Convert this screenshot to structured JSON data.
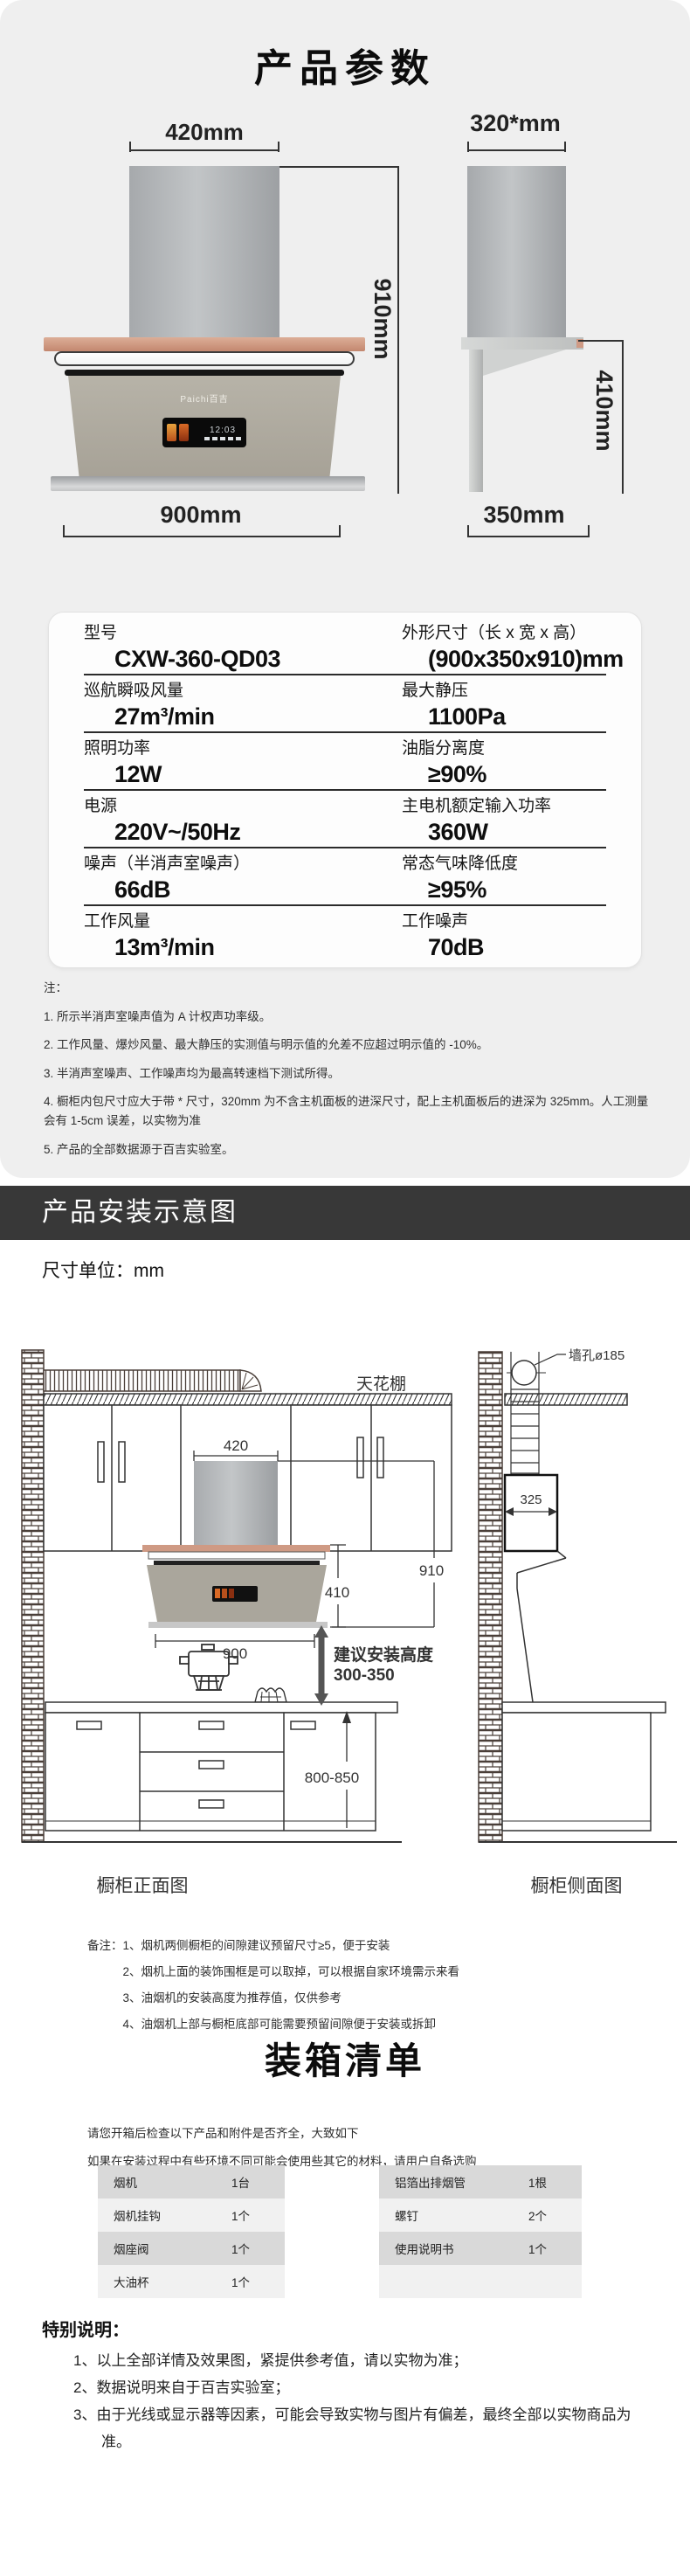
{
  "colors": {
    "panel_bg": "#efefef",
    "install_bar_bg": "#383838",
    "copper_accent": "#c3876f",
    "row_dark": "#d9d9d9",
    "row_light": "#f1f1f1"
  },
  "section_params": {
    "title": "产品参数",
    "front_view": {
      "top_width": "420mm",
      "height": "910mm",
      "bottom_width": "900mm",
      "brand": "Paichi百吉",
      "display_time": "12:03"
    },
    "side_view": {
      "top_width": "320*mm",
      "height": "410mm",
      "bottom_width": "350mm"
    },
    "spec_rows": [
      {
        "l_label": "型号",
        "l_value": "CXW-360-QD03",
        "r_label": "外形尺寸（长 x 宽 x 高）",
        "r_value": "(900x350x910)mm"
      },
      {
        "l_label": "巡航瞬吸风量",
        "l_value": "27m³/min",
        "r_label": "最大静压",
        "r_value": "1100Pa"
      },
      {
        "l_label": "照明功率",
        "l_value": "12W",
        "r_label": "油脂分离度",
        "r_value": "≥90%"
      },
      {
        "l_label": "电源",
        "l_value": "220V~/50Hz",
        "r_label": "主电机额定输入功率",
        "r_value": "360W"
      },
      {
        "l_label": "噪声（半消声室噪声）",
        "l_value": "66dB",
        "r_label": "常态气味降低度",
        "r_value": "≥95%"
      },
      {
        "l_label": "工作风量",
        "l_value": "13m³/min",
        "r_label": "工作噪声",
        "r_value": "70dB"
      }
    ],
    "notes_heading": "注：",
    "notes": [
      "1. 所示半消声室噪声值为 A 计权声功率级。",
      "2. 工作风量、爆炒风量、最大静压的实测值与明示值的允差不应超过明示值的 -10%。",
      "3. 半消声室噪声、工作噪声均为最高转速档下测试所得。",
      "4. 橱柜内包尺寸应大于带 * 尺寸，320mm 为不含主机面板的进深尺寸，配上主机面板后的进深为 325mm。人工测量会有 1-5cm 误差，以实物为准",
      "5. 产品的全部数据源于百吉实验室。"
    ]
  },
  "section_install": {
    "header": "产品安装示意图",
    "unit": "尺寸单位：mm",
    "diagram": {
      "ceiling": "天花棚",
      "chimney_width": "420",
      "hood_height": "910",
      "body_height": "410",
      "hood_width": "900",
      "install_hint_line1": "建议安装高度",
      "install_hint_line2": "300-350",
      "counter_height": "800-850",
      "side_depth": "325",
      "wall_hole": "墙孔ø185",
      "front_caption": "橱柜正面图",
      "side_caption": "橱柜侧面图"
    },
    "remarks_heading": "备注：",
    "remarks": [
      "1、烟机两侧橱柜的间隙建议预留尺寸≥5，便于安装",
      "2、烟机上面的装饰围框是可以取掉，可以根据自家环境需示来看",
      "3、油烟机的安装高度为推荐值，仅供参考",
      "4、油烟机上部与橱柜底部可能需要预留间隙便于安装或拆卸"
    ]
  },
  "section_packing": {
    "title": "装箱清单",
    "intro": [
      "请您开箱后检查以下产品和附件是否齐全，大致如下",
      "如果在安装过程中有些环境不同可能会使用些其它的材料，请用户自备选购"
    ],
    "left_items": [
      {
        "name": "烟机",
        "qty": "1台"
      },
      {
        "name": "烟机挂钩",
        "qty": "1个"
      },
      {
        "name": "烟座阀",
        "qty": "1个"
      },
      {
        "name": "大油杯",
        "qty": "1个"
      }
    ],
    "right_items": [
      {
        "name": "铝箔出排烟管",
        "qty": "1根"
      },
      {
        "name": "螺钉",
        "qty": "2个"
      },
      {
        "name": "使用说明书",
        "qty": "1个"
      },
      {
        "name": "",
        "qty": ""
      }
    ]
  },
  "section_special": {
    "heading": "特别说明：",
    "items": [
      "1、以上全部详情及效果图，紧提供参考值，请以实物为准；",
      "2、数据说明来自于百吉实验室；",
      "3、由于光线或显示器等因素，可能会导致实物与图片有偏差，最终全部以实物商品为准。"
    ]
  }
}
